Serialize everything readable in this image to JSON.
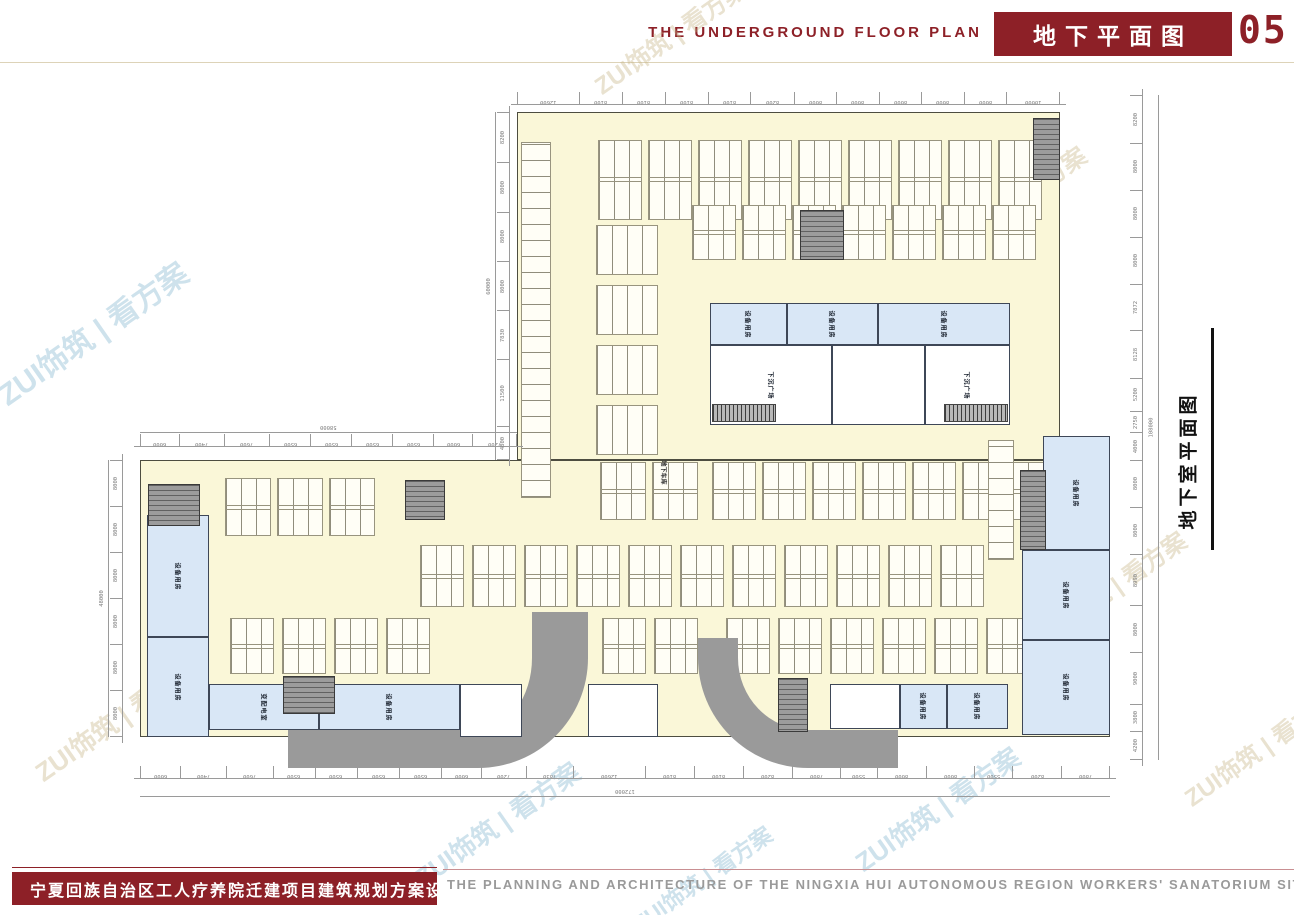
{
  "header": {
    "title_en": "THE UNDERGROUND FLOOR PLAN",
    "title_cn": "地下平面图",
    "page_no": "05",
    "accent_color": "#8D2027"
  },
  "side_label": {
    "text": "地下室平面图"
  },
  "footer": {
    "banner_cn": "宁夏回族自治区工人疗养院迁建项目建筑规划方案设计",
    "caption_en": "THE PLANNING AND ARCHITECTURE OF THE NINGXIA HUI AUTONOMOUS REGION WORKERS' SANATORIUM SITE"
  },
  "watermarks": {
    "text": "ZUI饰筑 | 看方案",
    "items": [
      {
        "x": 580,
        "y": 18,
        "tone": "tan",
        "size": 24
      },
      {
        "x": -20,
        "y": 310,
        "tone": "blue",
        "size": 30
      },
      {
        "x": 520,
        "y": 340,
        "tone": "blue",
        "size": 26
      },
      {
        "x": 920,
        "y": 185,
        "tone": "tan",
        "size": 24
      },
      {
        "x": 760,
        "y": 470,
        "tone": "blue",
        "size": 26
      },
      {
        "x": 1020,
        "y": 570,
        "tone": "tan",
        "size": 24
      },
      {
        "x": 20,
        "y": 700,
        "tone": "tan",
        "size": 26
      },
      {
        "x": 400,
        "y": 805,
        "tone": "blue",
        "size": 26
      },
      {
        "x": 840,
        "y": 790,
        "tone": "blue",
        "size": 26
      },
      {
        "x": 1170,
        "y": 730,
        "tone": "tan",
        "size": 24
      },
      {
        "x": 620,
        "y": 862,
        "tone": "blue",
        "size": 22
      }
    ]
  },
  "plan": {
    "colors": {
      "plate": "#FAF7D8",
      "room_blue": "#D9E7F6",
      "ramp": "#9A9A9A",
      "core": "#9C9C9C",
      "dim": "#9A9A9A",
      "outline": "#4D4D40"
    },
    "blocks": [
      {
        "x": 517,
        "y": 112,
        "w": 543,
        "h": 348
      },
      {
        "x": 140,
        "y": 460,
        "w": 970,
        "h": 277
      }
    ],
    "parking": [
      {
        "x": 598,
        "y": 140,
        "w": 44,
        "h": 80,
        "count": 9,
        "stepX": 50
      },
      {
        "x": 692,
        "y": 205,
        "w": 44,
        "h": 55,
        "count": 7,
        "stepX": 50
      },
      {
        "x": 596,
        "y": 225,
        "w": 62,
        "h": 50,
        "count": 4,
        "stepY": 60
      },
      {
        "x": 521,
        "y": 142,
        "w": 30,
        "h": 356,
        "count": 1,
        "vert": true
      },
      {
        "x": 600,
        "y": 462,
        "w": 46,
        "h": 58,
        "count": 2,
        "stepX": 52
      },
      {
        "x": 712,
        "y": 462,
        "w": 44,
        "h": 58,
        "count": 7,
        "stepX": 50
      },
      {
        "x": 988,
        "y": 440,
        "w": 26,
        "h": 120,
        "count": 1,
        "vert": true
      },
      {
        "x": 225,
        "y": 478,
        "w": 46,
        "h": 58,
        "count": 3,
        "stepX": 52
      },
      {
        "x": 420,
        "y": 545,
        "w": 44,
        "h": 62,
        "count": 11,
        "stepX": 52
      },
      {
        "x": 230,
        "y": 618,
        "w": 44,
        "h": 56,
        "count": 4,
        "stepX": 52
      },
      {
        "x": 602,
        "y": 618,
        "w": 44,
        "h": 56,
        "count": 2,
        "stepX": 52
      },
      {
        "x": 726,
        "y": 618,
        "w": 44,
        "h": 56,
        "count": 6,
        "stepX": 52
      }
    ],
    "rooms": [
      {
        "x": 710,
        "y": 303,
        "w": 77,
        "h": 42,
        "type": "blue",
        "label": "设备用房"
      },
      {
        "x": 787,
        "y": 303,
        "w": 91,
        "h": 42,
        "type": "blue",
        "label": "设备用房"
      },
      {
        "x": 878,
        "y": 303,
        "w": 132,
        "h": 42,
        "type": "blue",
        "label": "设备用房"
      },
      {
        "x": 710,
        "y": 345,
        "w": 122,
        "h": 80,
        "type": "white",
        "label": "下沉广场"
      },
      {
        "x": 832,
        "y": 345,
        "w": 93,
        "h": 80,
        "type": "white",
        "label": ""
      },
      {
        "x": 925,
        "y": 345,
        "w": 85,
        "h": 80,
        "type": "white",
        "label": "下沉广场"
      },
      {
        "x": 147,
        "y": 515,
        "w": 62,
        "h": 122,
        "type": "blue",
        "label": "设备用房"
      },
      {
        "x": 147,
        "y": 637,
        "w": 62,
        "h": 100,
        "type": "blue",
        "label": "设备用房"
      },
      {
        "x": 209,
        "y": 684,
        "w": 110,
        "h": 46,
        "type": "blue",
        "label": "变配电室"
      },
      {
        "x": 319,
        "y": 684,
        "w": 141,
        "h": 46,
        "type": "blue",
        "label": "设备用房"
      },
      {
        "x": 460,
        "y": 684,
        "w": 62,
        "h": 53,
        "type": "white",
        "label": ""
      },
      {
        "x": 588,
        "y": 684,
        "w": 70,
        "h": 53,
        "type": "white",
        "label": ""
      },
      {
        "x": 830,
        "y": 684,
        "w": 70,
        "h": 45,
        "type": "white",
        "label": ""
      },
      {
        "x": 900,
        "y": 684,
        "w": 47,
        "h": 45,
        "type": "blue",
        "label": "设备用房"
      },
      {
        "x": 947,
        "y": 684,
        "w": 61,
        "h": 45,
        "type": "blue",
        "label": "设备用房"
      },
      {
        "x": 1043,
        "y": 436,
        "w": 67,
        "h": 114,
        "type": "blue",
        "label": "设备用房"
      },
      {
        "x": 1022,
        "y": 550,
        "w": 88,
        "h": 90,
        "type": "blue",
        "label": "设备用房"
      },
      {
        "x": 1022,
        "y": 640,
        "w": 88,
        "h": 95,
        "type": "blue",
        "label": "设备用房"
      }
    ],
    "cores": [
      {
        "x": 1033,
        "y": 118,
        "w": 27,
        "h": 62
      },
      {
        "x": 800,
        "y": 210,
        "w": 44,
        "h": 50
      },
      {
        "x": 148,
        "y": 484,
        "w": 52,
        "h": 42
      },
      {
        "x": 405,
        "y": 480,
        "w": 40,
        "h": 40
      },
      {
        "x": 283,
        "y": 676,
        "w": 52,
        "h": 38
      },
      {
        "x": 778,
        "y": 678,
        "w": 30,
        "h": 54
      },
      {
        "x": 1020,
        "y": 470,
        "w": 26,
        "h": 80
      }
    ],
    "hatches": [
      {
        "x": 712,
        "y": 404,
        "w": 64,
        "h": 18
      },
      {
        "x": 944,
        "y": 404,
        "w": 64,
        "h": 18
      }
    ],
    "ramps": [
      {
        "x": 288,
        "y": 612,
        "w": 300,
        "h": 156,
        "corner": "br",
        "tb": 38,
        "ts": 56,
        "r": 110
      },
      {
        "x": 698,
        "y": 638,
        "w": 200,
        "h": 130,
        "corner": "bl",
        "tb": 38,
        "ts": 40,
        "r": 110
      }
    ],
    "tiny_labels": [
      {
        "x": 652,
        "y": 468,
        "text": "地下车库"
      }
    ],
    "dims_h": [
      {
        "x": 517,
        "y": 92,
        "w": 543,
        "segments": [
          "12600",
          "8100",
          "8100",
          "8100",
          "8100",
          "8200",
          "8000",
          "8000",
          "8000",
          "8000",
          "8000",
          "10000"
        ]
      },
      {
        "x": 140,
        "y": 434,
        "w": 377,
        "segments": [
          "6000",
          "7400",
          "7600",
          "6500",
          "6500",
          "6500",
          "6500",
          "6000",
          "7200"
        ]
      },
      {
        "x": 140,
        "y": 766,
        "w": 970,
        "segments": [
          "6000",
          "7400",
          "7600",
          "6500",
          "6500",
          "6500",
          "6500",
          "6000",
          "7200",
          "7830",
          "12600",
          "8100",
          "8100",
          "8200",
          "7800",
          "5500",
          "8000",
          "8000",
          "5500",
          "8200",
          "7800"
        ]
      }
    ],
    "dims_v": [
      {
        "x": 497,
        "y": 112,
        "h": 348,
        "segments": [
          "8200",
          "8000",
          "8000",
          "8000",
          "7830",
          "11500",
          "4800"
        ]
      },
      {
        "x": 110,
        "y": 460,
        "h": 277,
        "segments": [
          "8000",
          "8000",
          "8000",
          "8000",
          "8000",
          "8000"
        ]
      },
      {
        "x": 1130,
        "y": 95,
        "h": 665,
        "segments": [
          "8200",
          "8000",
          "8000",
          "8000",
          "7872",
          "8128",
          "5200",
          "2750",
          "4000",
          "8000",
          "8000",
          "8990",
          "8000",
          "9000",
          "3800",
          "4200"
        ]
      }
    ],
    "dim_totals": [
      {
        "value": "58000",
        "x": 140,
        "y": 420,
        "w": 377,
        "h": 12,
        "vert": false
      },
      {
        "value": "172000",
        "x": 140,
        "y": 784,
        "w": 970,
        "h": 12,
        "vert": false
      },
      {
        "value": "60000",
        "x": 483,
        "y": 112,
        "w": 12,
        "h": 348,
        "vert": true
      },
      {
        "value": "48000",
        "x": 96,
        "y": 460,
        "w": 12,
        "h": 277,
        "vert": true
      },
      {
        "value": "108000",
        "x": 1146,
        "y": 95,
        "w": 12,
        "h": 665,
        "vert": true
      }
    ]
  }
}
